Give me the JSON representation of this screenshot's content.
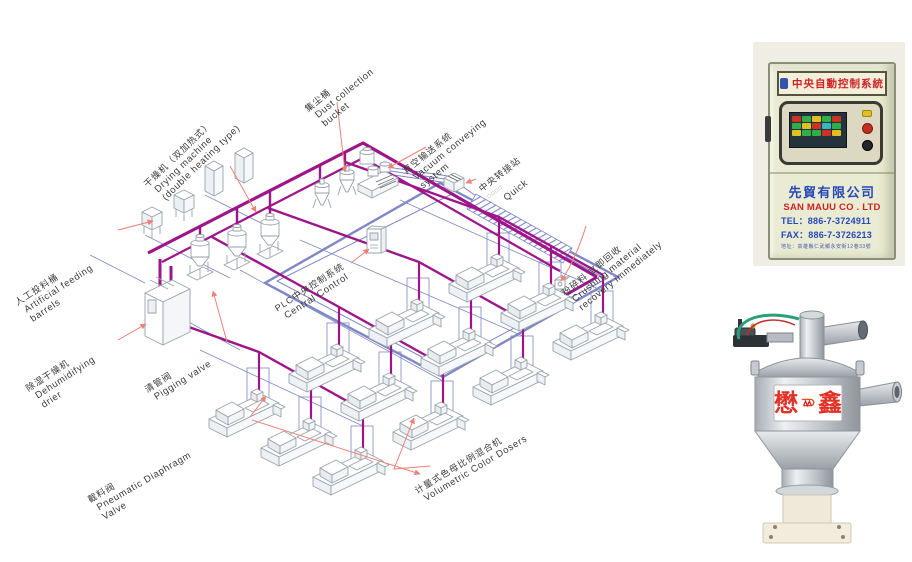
{
  "colors": {
    "pipe_magenta": "#9e1489",
    "pipe_blue": "#7f87c5",
    "leader_red": "#ef8078",
    "machine_line": "#9aa2ac",
    "label_text": "#3a3a3a",
    "cabinet_body": "#e9ecd2",
    "brand_red": "#e03226",
    "company_blue": "#2847b8"
  },
  "diagram": {
    "labels": [
      {
        "id": "drying-machine",
        "zh": "干燥机（双加热式）",
        "en": "Drying machine",
        "en2": "(double heating type)"
      },
      {
        "id": "dust-collection",
        "zh": "集尘桶",
        "en": "Dust collection",
        "en2": "bucket"
      },
      {
        "id": "vacuum-conveying",
        "zh": "真空输送系统",
        "en": "Vacuum conveying",
        "en2": "system"
      },
      {
        "id": "transfer-station",
        "zh": "中央转接站",
        "sub": "□□□□",
        "en": "Quick"
      },
      {
        "id": "artificial-feeding",
        "zh": "人工投料桶",
        "en": "Artificial feeding",
        "en2": "barrels"
      },
      {
        "id": "dehumidifying",
        "zh": "除湿干燥机",
        "en": "Dehumidifying",
        "en2": "drier"
      },
      {
        "id": "pigging-valve",
        "zh": "清管阀",
        "en": "Pigging valve"
      },
      {
        "id": "central-control",
        "zh": "PLC中央控制系统",
        "en": "Central Control"
      },
      {
        "id": "crushing-recovery",
        "zh": "粉碎料 立即回收",
        "en": "Crushing material",
        "en2": "recovery immediately"
      },
      {
        "id": "pneumatic-valve",
        "zh": "截料阀",
        "en": "Pneumatic Diaphragm",
        "en2": "Valve"
      },
      {
        "id": "color-dosers",
        "zh": "计量式色母比例混合机",
        "en": "Volumetric Color Dosers"
      }
    ]
  },
  "cabinet": {
    "header": "中央自動控制系統",
    "company_zh": "先貿有限公司",
    "company_en": "SAN MAUU CO . LTD",
    "tel": "TEL：886-7-3724911",
    "fax": "FAX：886-7-3726213",
    "address": "地址：高雄縣仁武鄉永安街12巷33號"
  },
  "hopper": {
    "brand_left": "懋",
    "brand_right": "鑫"
  }
}
